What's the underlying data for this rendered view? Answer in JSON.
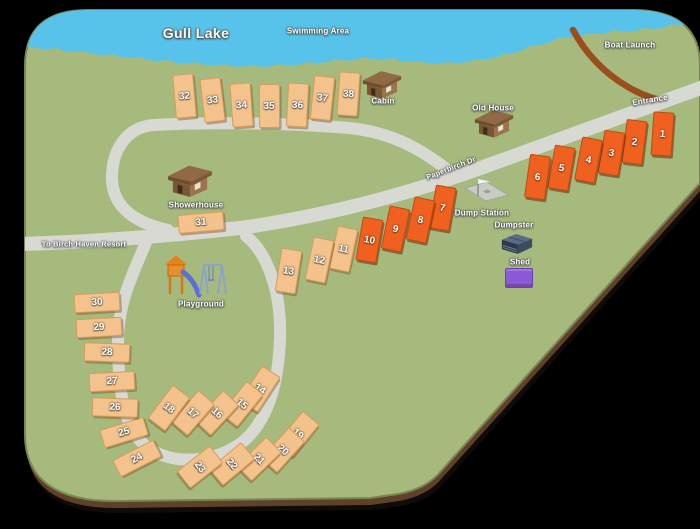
{
  "map": {
    "title": "Gull Lake",
    "labels": {
      "swimming_area": "Swimming Area",
      "boat_launch": "Boat Launch",
      "entrance": "Entrance",
      "road_name": "Paperbirch Dr",
      "cabin": "Cabin",
      "old_house": "Old House",
      "showerhouse": "Showerhouse",
      "dump_station": "Dump Station",
      "dumpster": "Dumpster",
      "shed": "Shed",
      "playground": "Playground",
      "to_resort": "To Birch Haven Resort"
    },
    "colors": {
      "water": "#58c3ea",
      "grass": "#a6ba7e",
      "road": "#d9d9d4",
      "dirt_road": "#9a4e1c",
      "map_edge": "#5e4128",
      "site_standard": "#f4c28c",
      "site_premium": "#f0601f",
      "shed": "#8d5ad6"
    }
  },
  "sites": [
    {
      "num": "1",
      "x": 661,
      "y": 133,
      "rot": 4,
      "shape": "v",
      "type": "premium"
    },
    {
      "num": "2",
      "x": 633,
      "y": 141,
      "rot": 7,
      "shape": "v",
      "type": "premium"
    },
    {
      "num": "3",
      "x": 610,
      "y": 152,
      "rot": 9,
      "shape": "v",
      "type": "premium"
    },
    {
      "num": "4",
      "x": 587,
      "y": 159,
      "rot": 11,
      "shape": "v",
      "type": "premium"
    },
    {
      "num": "5",
      "x": 560,
      "y": 167,
      "rot": 10,
      "shape": "v",
      "type": "premium"
    },
    {
      "num": "6",
      "x": 536,
      "y": 176,
      "rot": 8,
      "shape": "v",
      "type": "premium"
    },
    {
      "num": "7",
      "x": 441,
      "y": 207,
      "rot": 10,
      "shape": "v",
      "type": "premium"
    },
    {
      "num": "8",
      "x": 419,
      "y": 219,
      "rot": 12,
      "shape": "v",
      "type": "premium"
    },
    {
      "num": "9",
      "x": 394,
      "y": 228,
      "rot": 12,
      "shape": "v",
      "type": "premium"
    },
    {
      "num": "10",
      "x": 368,
      "y": 239,
      "rot": 10,
      "shape": "v",
      "type": "premium"
    },
    {
      "num": "11",
      "x": 342,
      "y": 248,
      "rot": 12,
      "shape": "v",
      "type": "standard"
    },
    {
      "num": "12",
      "x": 318,
      "y": 259,
      "rot": 12,
      "shape": "v",
      "type": "standard"
    },
    {
      "num": "13",
      "x": 287,
      "y": 270,
      "rot": 9,
      "shape": "v",
      "type": "standard"
    },
    {
      "num": "14",
      "x": 259,
      "y": 388,
      "rot": 33,
      "shape": "d",
      "type": "standard"
    },
    {
      "num": "15",
      "x": 241,
      "y": 403,
      "rot": 39,
      "shape": "d",
      "type": "standard"
    },
    {
      "num": "16",
      "x": 216,
      "y": 412,
      "rot": 43,
      "shape": "d",
      "type": "standard"
    },
    {
      "num": "17",
      "x": 192,
      "y": 412,
      "rot": 41,
      "shape": "d",
      "type": "standard"
    },
    {
      "num": "18",
      "x": 168,
      "y": 407,
      "rot": 37,
      "shape": "d",
      "type": "standard"
    },
    {
      "num": "19",
      "x": 297,
      "y": 433,
      "rot": 39,
      "shape": "d",
      "type": "standard"
    },
    {
      "num": "20",
      "x": 282,
      "y": 449,
      "rot": 42,
      "shape": "d",
      "type": "standard"
    },
    {
      "num": "21",
      "x": 258,
      "y": 458,
      "rot": 46,
      "shape": "d",
      "type": "standard"
    },
    {
      "num": "22",
      "x": 231,
      "y": 463,
      "rot": 50,
      "shape": "d",
      "type": "standard"
    },
    {
      "num": "23",
      "x": 199,
      "y": 466,
      "rot": 52,
      "shape": "d",
      "type": "standard"
    },
    {
      "num": "24",
      "x": 136,
      "y": 457,
      "rot": -27,
      "shape": "h",
      "type": "standard"
    },
    {
      "num": "25",
      "x": 123,
      "y": 431,
      "rot": -17,
      "shape": "h",
      "type": "standard"
    },
    {
      "num": "26",
      "x": 114,
      "y": 406,
      "rot": 2,
      "shape": "h",
      "type": "standard"
    },
    {
      "num": "27",
      "x": 111,
      "y": 380,
      "rot": -3,
      "shape": "h",
      "type": "standard"
    },
    {
      "num": "28",
      "x": 106,
      "y": 351,
      "rot": 2,
      "shape": "h",
      "type": "standard"
    },
    {
      "num": "29",
      "x": 98,
      "y": 326,
      "rot": -3,
      "shape": "h",
      "type": "standard"
    },
    {
      "num": "30",
      "x": 96,
      "y": 301,
      "rot": -3,
      "shape": "h",
      "type": "standard"
    },
    {
      "num": "31",
      "x": 200,
      "y": 221,
      "rot": -5,
      "shape": "h",
      "type": "standard"
    },
    {
      "num": "32",
      "x": 183,
      "y": 95,
      "rot": -5,
      "shape": "v",
      "type": "standard"
    },
    {
      "num": "33",
      "x": 211,
      "y": 99,
      "rot": -7,
      "shape": "v",
      "type": "standard"
    },
    {
      "num": "34",
      "x": 240,
      "y": 104,
      "rot": -4,
      "shape": "v",
      "type": "standard"
    },
    {
      "num": "35",
      "x": 268,
      "y": 105,
      "rot": 0,
      "shape": "v",
      "type": "standard"
    },
    {
      "num": "36",
      "x": 296,
      "y": 104,
      "rot": 3,
      "shape": "v",
      "type": "standard"
    },
    {
      "num": "37",
      "x": 321,
      "y": 97,
      "rot": 6,
      "shape": "v",
      "type": "standard"
    },
    {
      "num": "38",
      "x": 347,
      "y": 93,
      "rot": 4,
      "shape": "v",
      "type": "standard"
    }
  ]
}
